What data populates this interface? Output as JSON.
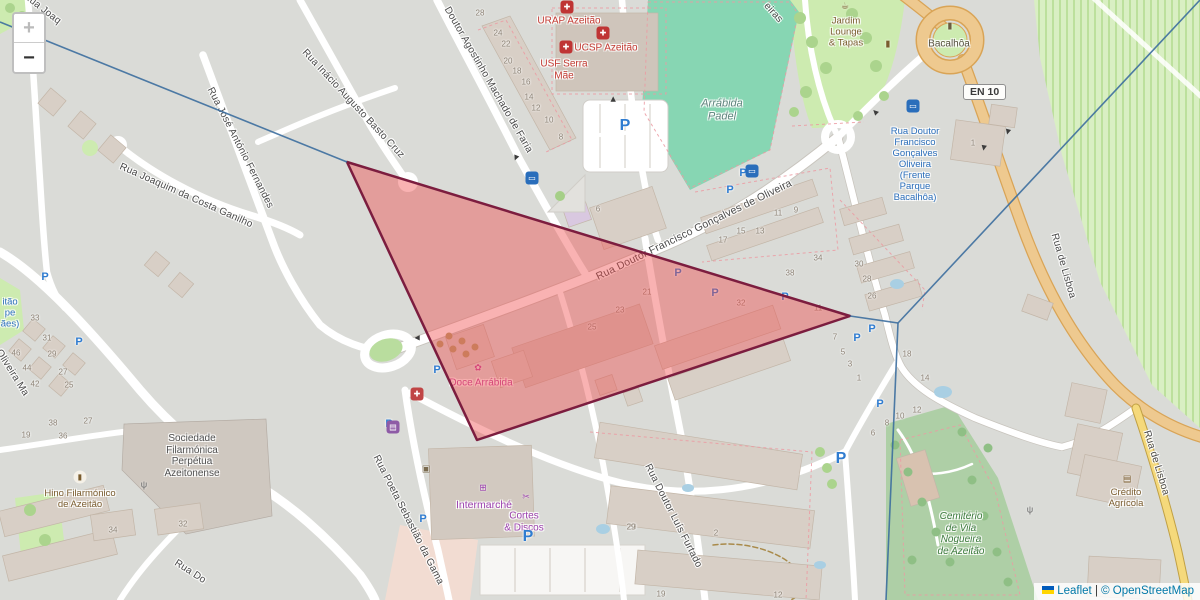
{
  "controls": {
    "zoom_in": "+",
    "zoom_out": "−"
  },
  "attribution": {
    "leaflet": "Leaflet",
    "sep": " | ",
    "copyright": "© OpenStreetMap"
  },
  "road_shield": {
    "text": "EN 10"
  },
  "colors": {
    "link_blue": "#0078a8",
    "flag_blue": "#005bbb",
    "flag_yellow": "#ffd500",
    "overlay_fill": "#f04848",
    "overlay_border": "#7c1d3f",
    "route_line_blue": "#3c6e9e",
    "trunk_road": "#eec98f",
    "tertiary_road": "#f5d97b",
    "pitch_teal": "#87d6b3",
    "park_green": "#cdebb0",
    "cemetery_green": "#aecfa6"
  },
  "map": {
    "parking_glyph": "P",
    "arrow_glyph": "▶",
    "street_labels": [
      {
        "text": "Rua Joaq",
        "x": 42,
        "y": 9,
        "rot": 38
      },
      {
        "text": "Rua José António Fernandes",
        "x": 240,
        "y": 148,
        "rot": 63
      },
      {
        "text": "Rua Inácio Augusto Basto Cruz",
        "x": 353,
        "y": 104,
        "rot": 47
      },
      {
        "text": "Rua Joaquim da Costa Ganilho",
        "x": 186,
        "y": 196,
        "rot": 24
      },
      {
        "text": "Doutor Agostinho Machado de Faria",
        "x": 488,
        "y": 80,
        "rot": 60
      },
      {
        "text": "Rua Doutor Francisco Gonçalves de Oliveira",
        "x": 694,
        "y": 230,
        "rot": -26,
        "size": 10.5
      },
      {
        "text": "Rua Doutor Luís Furtado",
        "x": 673,
        "y": 516,
        "rot": 63
      },
      {
        "text": "Rua Poeta Sebastião da Gama",
        "x": 408,
        "y": 520,
        "rot": 63
      },
      {
        "text": "Rua de Lisboa",
        "x": 1063,
        "y": 266,
        "rot": 74
      },
      {
        "text": "Rua de Lisboa",
        "x": 1156,
        "y": 463,
        "rot": 73
      },
      {
        "text": "Oliveira Ma",
        "x": 12,
        "y": 373,
        "rot": 58
      },
      {
        "text": "Rua Do",
        "x": 190,
        "y": 572,
        "rot": 33
      },
      {
        "text": "eiras",
        "x": 773,
        "y": 13,
        "rot": 48
      }
    ],
    "poi_labels": [
      {
        "lines": [
          "URAP Azeitão"
        ],
        "x": 569,
        "y": 21,
        "color": "#c33931"
      },
      {
        "lines": [
          "UCSP Azeitão"
        ],
        "x": 606,
        "y": 48,
        "color": "#c33931"
      },
      {
        "lines": [
          "USF Serra",
          "Mãe"
        ],
        "x": 564,
        "y": 70,
        "color": "#c33931"
      },
      {
        "lines": [
          "Arrábida",
          "Padel"
        ],
        "x": 722,
        "y": 110,
        "color": "#5e837c",
        "italic": true,
        "size": 11
      },
      {
        "lines": [
          "Jardim",
          "Lounge",
          "& Tapas"
        ],
        "x": 846,
        "y": 33,
        "color": "#7a5c2e",
        "size": 9.5
      },
      {
        "lines": [
          "Bacalhôa"
        ],
        "x": 949,
        "y": 44,
        "color": "#55503f",
        "size": 10
      },
      {
        "lines": [
          "Rua Doutor",
          "Francisco",
          "Gonçalves",
          "Oliveira",
          "(Frente",
          "Parque",
          "Bacalhôa)"
        ],
        "x": 915,
        "y": 165,
        "color": "#2a6ebb",
        "size": 9.5
      },
      {
        "lines": [
          "Doce Arrábida"
        ],
        "x": 481,
        "y": 383,
        "color": "#c2479d",
        "size": 10
      },
      {
        "lines": [
          "Intermarché"
        ],
        "x": 484,
        "y": 505,
        "color": "#9b3fae",
        "size": 10.5
      },
      {
        "lines": [
          "Cortes",
          "& Discos"
        ],
        "x": 524,
        "y": 522,
        "color": "#9b3fae"
      },
      {
        "lines": [
          "Sociedade",
          "Filarmónica",
          "Perpétua",
          "Azeitonense"
        ],
        "x": 192,
        "y": 456,
        "color": "#4f4f4f",
        "size": 10
      },
      {
        "lines": [
          "Hino Filarmónico",
          "de Azeitão"
        ],
        "x": 80,
        "y": 500,
        "color": "#7a5c2e",
        "size": 9.5
      },
      {
        "lines": [
          "Cemitério",
          "de Vila",
          "Nogueira",
          "de Azeitão"
        ],
        "x": 961,
        "y": 534,
        "color": "#3c7a3c",
        "italic": true,
        "size": 10
      },
      {
        "lines": [
          "Crédito",
          "Agrícola"
        ],
        "x": 1126,
        "y": 499,
        "color": "#7a5c2e",
        "size": 9.5
      },
      {
        "lines": [
          "itão",
          "pe",
          "ães)"
        ],
        "x": 10,
        "y": 314,
        "color": "#2a6ebb",
        "size": 9.5
      }
    ],
    "house_numbers": [
      [
        "28",
        480,
        13
      ],
      [
        "24",
        498,
        33
      ],
      [
        "22",
        506,
        44
      ],
      [
        "20",
        508,
        61
      ],
      [
        "18",
        517,
        71
      ],
      [
        "16",
        526,
        82
      ],
      [
        "14",
        529,
        97
      ],
      [
        "12",
        536,
        108
      ],
      [
        "10",
        549,
        120
      ],
      [
        "8",
        561,
        137
      ],
      [
        "6",
        598,
        209
      ],
      [
        "17",
        723,
        240
      ],
      [
        "15",
        741,
        231
      ],
      [
        "13",
        760,
        231
      ],
      [
        "11",
        778,
        213
      ],
      [
        "9",
        796,
        210
      ],
      [
        "38",
        790,
        273
      ],
      [
        "34",
        818,
        258
      ],
      [
        "30",
        859,
        264
      ],
      [
        "28",
        867,
        279
      ],
      [
        "26",
        872,
        296
      ],
      [
        "32",
        741,
        303
      ],
      [
        "11",
        818,
        308
      ],
      [
        "7",
        835,
        337
      ],
      [
        "5",
        843,
        352
      ],
      [
        "3",
        850,
        364
      ],
      [
        "1",
        859,
        378
      ],
      [
        "18",
        907,
        354
      ],
      [
        "14",
        925,
        378
      ],
      [
        "6",
        873,
        433
      ],
      [
        "8",
        887,
        423
      ],
      [
        "10",
        900,
        416
      ],
      [
        "12",
        917,
        410
      ],
      [
        "21",
        647,
        292
      ],
      [
        "23",
        620,
        310
      ],
      [
        "25",
        592,
        327
      ],
      [
        "2",
        716,
        533
      ],
      [
        "29",
        632,
        527
      ],
      [
        "19",
        661,
        594
      ],
      [
        "12",
        778,
        595
      ],
      [
        "33",
        35,
        318
      ],
      [
        "31",
        47,
        338
      ],
      [
        "46",
        16,
        353
      ],
      [
        "29",
        52,
        354
      ],
      [
        "44",
        27,
        368
      ],
      [
        "27",
        63,
        372
      ],
      [
        "42",
        35,
        384
      ],
      [
        "25",
        69,
        385
      ],
      [
        "38",
        53,
        423
      ],
      [
        "36",
        63,
        436
      ],
      [
        "27",
        88,
        421
      ],
      [
        "19",
        26,
        435
      ],
      [
        "34",
        113,
        530
      ],
      [
        "32",
        183,
        524
      ],
      [
        "1",
        973,
        143
      ],
      [
        "29",
        631,
        527
      ]
    ],
    "parking": [
      [
        625,
        126,
        1
      ],
      [
        730,
        190,
        0
      ],
      [
        743,
        173,
        0
      ],
      [
        678,
        273,
        0
      ],
      [
        715,
        293,
        0
      ],
      [
        785,
        297,
        0
      ],
      [
        857,
        338,
        0
      ],
      [
        872,
        329,
        0
      ],
      [
        437,
        370,
        0
      ],
      [
        389,
        424,
        0
      ],
      [
        423,
        519,
        0
      ],
      [
        528,
        537,
        1
      ],
      [
        841,
        459,
        1
      ],
      [
        880,
        404,
        0
      ],
      [
        45,
        277,
        0
      ],
      [
        79,
        342,
        0
      ]
    ],
    "icons": [
      {
        "name": "hospital-icon",
        "x": 567,
        "y": 7,
        "glyph": "✚",
        "fg": "#fff",
        "bg": "#bf3434"
      },
      {
        "name": "hospital-icon",
        "x": 603,
        "y": 33,
        "glyph": "✚",
        "fg": "#fff",
        "bg": "#bf3434"
      },
      {
        "name": "hospital-icon",
        "x": 566,
        "y": 47,
        "glyph": "✚",
        "fg": "#fff",
        "bg": "#bf3434"
      },
      {
        "name": "pharmacy-icon",
        "x": 417,
        "y": 394,
        "glyph": "✚",
        "fg": "#fff",
        "bg": "#c04545"
      },
      {
        "name": "convenience-store-icon",
        "x": 393,
        "y": 427,
        "glyph": "▤",
        "fg": "#fff",
        "bg": "#8e5ba6"
      },
      {
        "name": "bakery-icon",
        "x": 478,
        "y": 368,
        "glyph": "✿",
        "fg": "#c2479d"
      },
      {
        "name": "supermarket-cart-icon",
        "x": 483,
        "y": 488,
        "glyph": "⊞",
        "fg": "#9b3fae"
      },
      {
        "name": "scissors-icon",
        "x": 526,
        "y": 497,
        "glyph": "✂",
        "fg": "#9b3fae"
      },
      {
        "name": "cafe-icon",
        "x": 845,
        "y": 6,
        "glyph": "☕",
        "fg": "#7a5c2e"
      },
      {
        "name": "monument-icon",
        "x": 888,
        "y": 44,
        "glyph": "▮",
        "fg": "#7a5c2e"
      },
      {
        "name": "monument-icon",
        "x": 950,
        "y": 26,
        "glyph": "▮",
        "fg": "#6b5d3f"
      },
      {
        "name": "monument-icon",
        "x": 80,
        "y": 477,
        "glyph": "▮",
        "fg": "#7a5c2e",
        "bg": "#f5f1e8",
        "round": true
      },
      {
        "name": "antenna-icon",
        "x": 144,
        "y": 485,
        "glyph": "ψ",
        "fg": "#666666"
      },
      {
        "name": "antenna-icon",
        "x": 1030,
        "y": 510,
        "glyph": "ψ",
        "fg": "#666666"
      },
      {
        "name": "bank-icon",
        "x": 1127,
        "y": 479,
        "glyph": "▤",
        "fg": "#7a5c2e"
      },
      {
        "name": "waste-basket-icon",
        "x": 426,
        "y": 469,
        "glyph": "▣",
        "fg": "#7a6b4f"
      },
      {
        "name": "bus-stop-icon",
        "x": 913,
        "y": 106,
        "glyph": "▭",
        "fg": "#fff",
        "bg": "#2a6ebb"
      },
      {
        "name": "bus-stop-icon",
        "x": 532,
        "y": 178,
        "glyph": "▭",
        "fg": "#fff",
        "bg": "#2a6ebb"
      },
      {
        "name": "bus-stop-icon",
        "x": 752,
        "y": 171,
        "glyph": "▭",
        "fg": "#fff",
        "bg": "#2a6ebb"
      }
    ],
    "arrows": [
      {
        "x": 417,
        "y": 338,
        "rot": 180
      },
      {
        "x": 516,
        "y": 158,
        "rot": 112
      },
      {
        "x": 875,
        "y": 112,
        "rot": 225
      },
      {
        "x": 984,
        "y": 148,
        "rot": 100
      },
      {
        "x": 613,
        "y": 99,
        "rot": 270
      },
      {
        "x": 1008,
        "y": 132,
        "rot": 105
      }
    ],
    "overlay": {
      "polygon": {
        "points": [
          [
            347,
            162
          ],
          [
            850,
            316
          ],
          [
            477,
            440
          ]
        ],
        "stroke": "#7c1d3f",
        "stroke_width": 2.5,
        "fill": "#f04848",
        "fill_opacity": 0.42
      },
      "lines": {
        "stroke": "#3c6e9e",
        "stroke_width": 1.6,
        "opacity": 0.9,
        "paths": [
          [
            [
              0,
              22
            ],
            [
              347,
              162
            ]
          ],
          [
            [
              1200,
              0
            ],
            [
              898,
              323
            ]
          ],
          [
            [
              850,
              316
            ],
            [
              898,
              323
            ]
          ],
          [
            [
              898,
              323
            ],
            [
              886,
              600
            ]
          ]
        ]
      }
    }
  }
}
